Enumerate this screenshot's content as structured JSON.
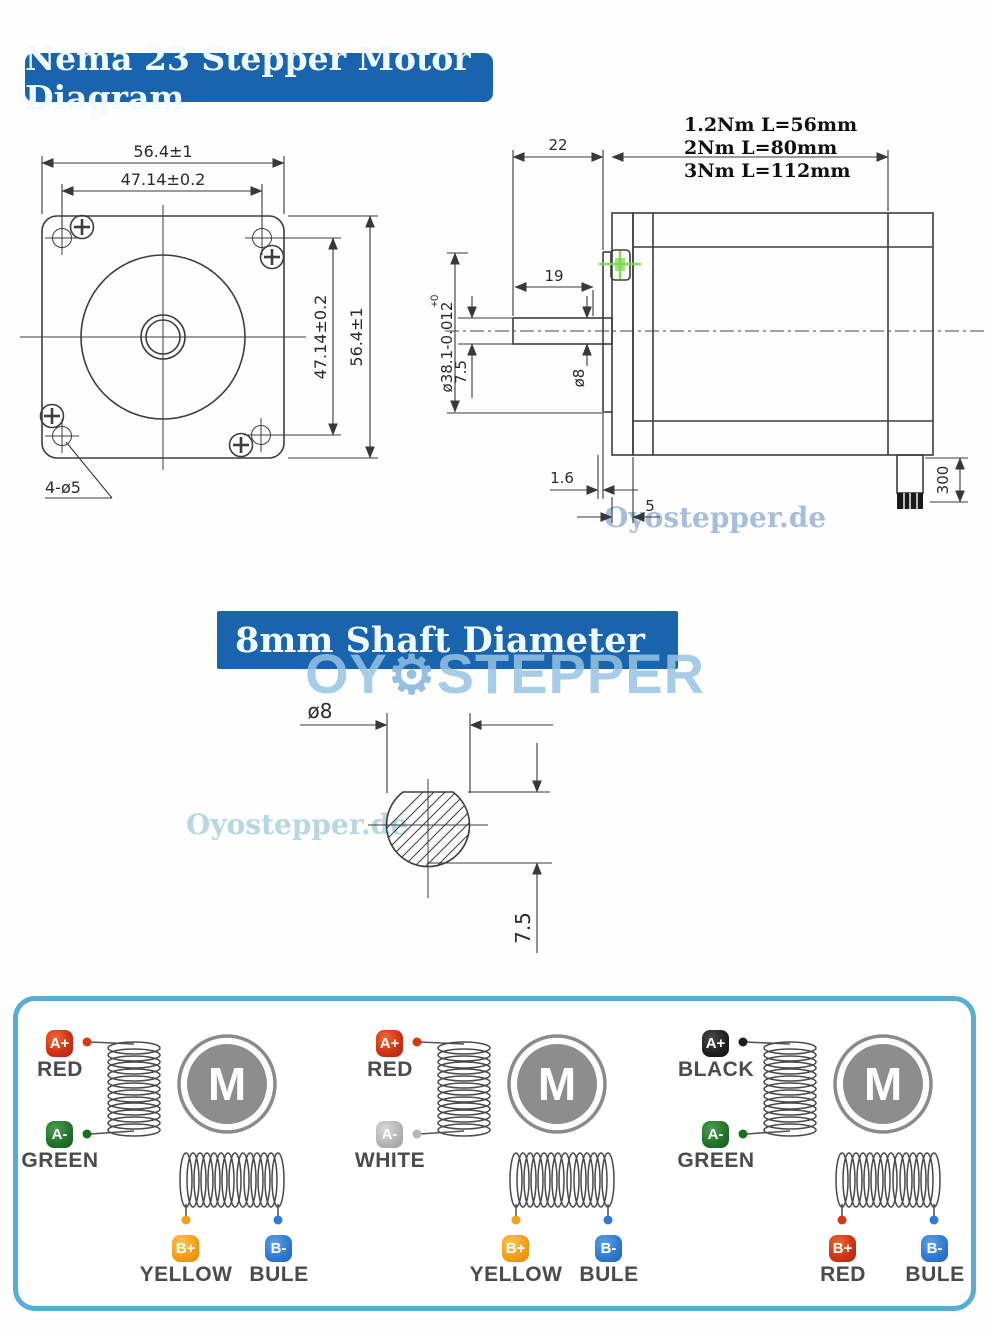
{
  "title_banner": {
    "text": "Nema 23 Stepper Motor Diagram",
    "bg_color": "#1a64ae"
  },
  "shaft_banner": {
    "text": "8mm Shaft Diameter",
    "bg_color": "#1a64ae"
  },
  "watermarks": {
    "site_side_view": "Oyostepper.de",
    "site_shaft_view": "Oyostepper.de",
    "logo_left": "OY",
    "logo_gear_icon": "⚙",
    "logo_right": "STEPPER"
  },
  "front_view": {
    "dims": {
      "width_outer": "56.4±1",
      "width_holes": "47.14±0.2",
      "height_holes": "47.14±0.2",
      "height_outer": "56.4±1",
      "mounting_holes": "4-ø5"
    }
  },
  "side_view": {
    "dims": {
      "shaft_protrusion": "22",
      "shaft_usable": "19",
      "pilot_dia": "ø38.1-0.012",
      "pilot_dia_tol": "+0",
      "shaft_flat_height": "7.5",
      "shaft_dia": "ø8",
      "flange_gap": "1.6",
      "boss_depth": "5",
      "cable_length": "300"
    },
    "torque_options": [
      "1.2Nm L=56mm",
      "2Nm L=80mm",
      "3Nm L=112mm"
    ]
  },
  "shaft_section": {
    "dims": {
      "dia": "ø8",
      "flat_height": "7.5"
    }
  },
  "wiring": {
    "motor_label": "M",
    "panels": [
      {
        "a_plus": {
          "badge": "A+",
          "label": "RED",
          "color": "#d43a1a"
        },
        "a_minus": {
          "badge": "A-",
          "label": "GREEN",
          "color": "#1e6b28"
        },
        "b_plus": {
          "badge": "B+",
          "label": "YELLOW",
          "color": "#f0a21c"
        },
        "b_minus": {
          "badge": "B-",
          "label": "BULE",
          "color": "#2e7cd0"
        }
      },
      {
        "a_plus": {
          "badge": "A+",
          "label": "RED",
          "color": "#d43a1a"
        },
        "a_minus": {
          "badge": "A-",
          "label": "WHITE",
          "color": "#b7b7b7"
        },
        "b_plus": {
          "badge": "B+",
          "label": "YELLOW",
          "color": "#f0a21c"
        },
        "b_minus": {
          "badge": "B-",
          "label": "BULE",
          "color": "#2e7cd0"
        }
      },
      {
        "a_plus": {
          "badge": "A+",
          "label": "BLACK",
          "color": "#1d1d1d"
        },
        "a_minus": {
          "badge": "A-",
          "label": "GREEN",
          "color": "#1e6b28"
        },
        "b_plus": {
          "badge": "B+",
          "label": "RED",
          "color": "#d43a1a"
        },
        "b_minus": {
          "badge": "B-",
          "label": "BULE",
          "color": "#2e7cd0"
        }
      }
    ]
  }
}
